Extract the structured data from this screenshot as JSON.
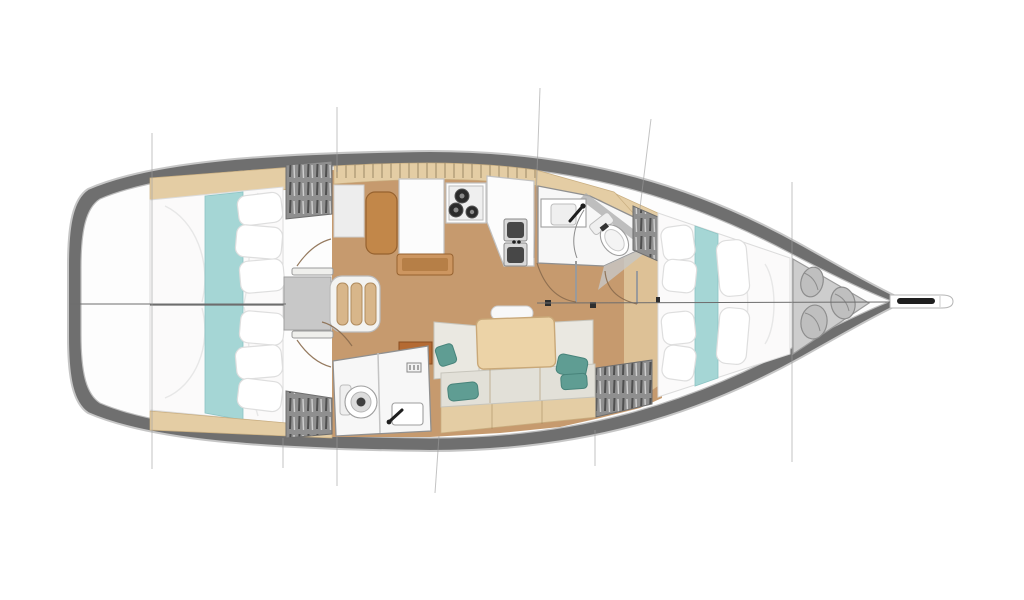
{
  "diagram": {
    "type": "sailboat-interior-floorplan",
    "orientation": "bow-right",
    "features": [
      "aft-cabin-port-double-berth",
      "aft-cabin-starboard-double-berth",
      "hanging-locker-port",
      "hanging-locker-starboard",
      "companionway-steps",
      "nav-station-seat",
      "galley-stove",
      "galley-double-sink",
      "forward-head-toilet",
      "forward-head-sink",
      "aft-head-toilet",
      "aft-head-sink",
      "saloon-l-settee",
      "saloon-table",
      "forward-cabin-v-berth",
      "anchor-sail-locker",
      "rope-coils",
      "bowsprit-anchor-roller"
    ]
  },
  "palette": {
    "hull_band": "#6f6f6f",
    "hull_stroke": "#c6c6c6",
    "deck": "#fdfdfd",
    "deck_stroke": "#bdbdbd",
    "floor": "#c69a6e",
    "wood_strip": "#e4cda4",
    "wood_stroke": "#c9ae80",
    "wood_tick": "#a08455",
    "mattress": "#fbfafa",
    "mattress_stroke": "#dcdcdc",
    "fold": "#e7e7e7",
    "runner": "#a5d6d5",
    "runner_edge": "#8cc4c4",
    "pillow": "#ffffff",
    "pillow_stroke": "#dedede",
    "hatch_base": "#8f8f8f",
    "hatch_dark": "#4f4f4f",
    "hatch_light": "#cfcfcf",
    "hatch_stroke": "#6e6e6e",
    "cushion": "#eae8e1",
    "cushion2": "#e2e0d8",
    "cushion_stroke": "#c7c5bc",
    "teal_pillow": "#5f9d93",
    "teal_pillow_edge": "#47837a",
    "table": "#ecd3a7",
    "table_stroke": "#c9a878",
    "bench": "#f8f8f8",
    "sienna": "#b46a33",
    "sienna_stroke": "#8a4f22",
    "white_block": "#fcfcfc",
    "white_stroke": "#c2c2c2",
    "seat": "#c28749",
    "seat_stroke": "#96622f",
    "box": "#cd9660",
    "box_inner": "#b67f47",
    "basin": "#474747",
    "metal": "#1f1f1f",
    "head_floor": "#f7f7f7",
    "gray_wall": "#ababab",
    "locker": "#cdcdcd",
    "locker_stroke": "#9b9b9b",
    "rope": "#bfbfbf",
    "rope_stroke": "#8d8d8d",
    "leaf": "#efefec",
    "leaf_stroke": "#9a9a9a",
    "arc": "#8a6b4e",
    "stop_sq": "#2e2e2e",
    "centerline": "#6d6d6d",
    "section_line": "#9c9c9c"
  }
}
